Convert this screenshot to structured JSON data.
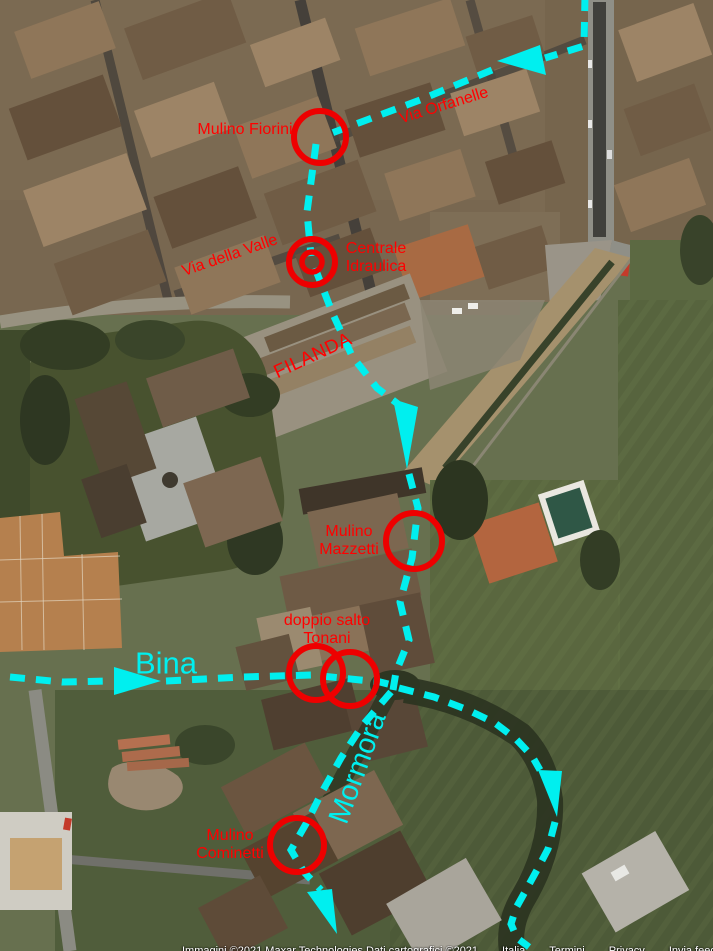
{
  "map": {
    "type": "satellite-imagery-with-annotations",
    "colors": {
      "annotation_red": "#ee0000",
      "label_red": "#ff0000",
      "waterway_cyan": "#00efef"
    },
    "annotations": {
      "sites": [
        {
          "id": "mulino-fiorini",
          "label": "Mulino Fiorini"
        },
        {
          "id": "centrale-idraulica",
          "label": "Centrale\nIdraulica"
        },
        {
          "id": "filanda",
          "label": "FILANDA"
        },
        {
          "id": "mulino-mazzetti",
          "label": "Mulino\nMazzetti"
        },
        {
          "id": "doppio-salto-tonani",
          "label": "doppio salto\nTonani"
        },
        {
          "id": "mulino-cominetti",
          "label": "Mulino\nCominetti"
        }
      ],
      "streets": [
        {
          "id": "via-orfanelle",
          "label": "Via Orfanelle"
        },
        {
          "id": "via-della-valle",
          "label": "Via della Valle"
        }
      ],
      "waterways": [
        {
          "id": "bina",
          "label": "Bina",
          "flow": "west-to-east"
        },
        {
          "id": "mormora",
          "label": "Mormora",
          "flow": "north-to-south"
        }
      ]
    },
    "attribution": {
      "credit": "Immagini ©2021 Maxar Technologies Dati cartografici ©2021",
      "links": [
        "Italia",
        "Termini",
        "Privacy",
        "Invia feedback"
      ]
    }
  }
}
